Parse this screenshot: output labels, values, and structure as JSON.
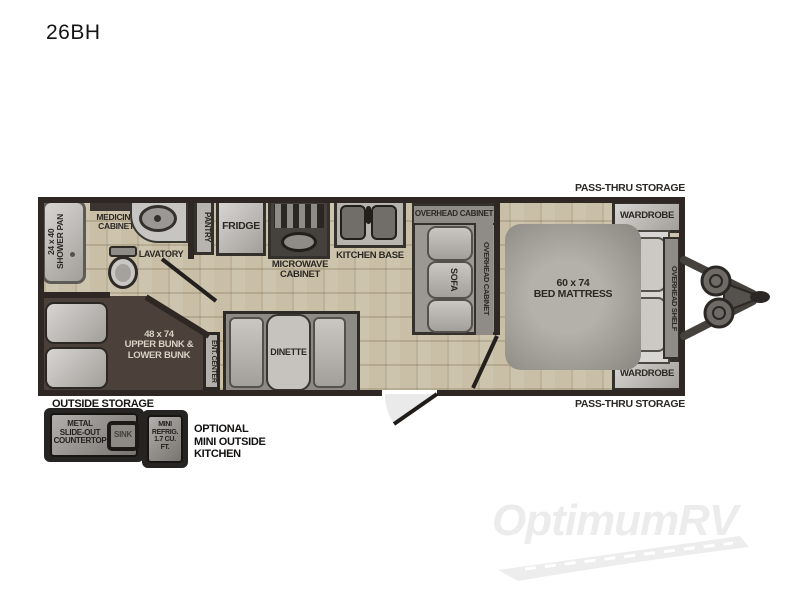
{
  "page": {
    "title": "26BH"
  },
  "plan": {
    "exterior": {
      "pass_thru_top": "PASS-THRU STORAGE",
      "pass_thru_bottom": "PASS-THRU STORAGE",
      "outside_storage": "OUTSIDE STORAGE"
    },
    "bathroom": {
      "shower": "24 x 40\nSHOWER PAN",
      "medicine_cabinet": "MEDICINE\nCABINET",
      "lavatory": "LAVATORY",
      "pantry": "PANTRY"
    },
    "kitchen": {
      "fridge": "FRIDGE",
      "microwave_cabinet": "MICROWAVE\nCABINET",
      "kitchen_base": "KITCHEN BASE",
      "overhead_cabinet_top": "OVERHEAD CABINET"
    },
    "living": {
      "sofa": "SOFA",
      "overhead_cabinet_side": "OVERHEAD CABINET",
      "dinette": "DINETTE",
      "ent_center": "ENT. CENTER",
      "bunks": "48 x 74\nUPPER BUNK &\nLOWER BUNK"
    },
    "bedroom": {
      "bed": "60 x 74\nBED MATTRESS",
      "wardrobe_top": "WARDROBE",
      "wardrobe_bottom": "WARDROBE",
      "overhead_shelf": "OVERHEAD SHELF"
    },
    "outside_kitchen": {
      "countertop": "METAL\nSLIDE-OUT\nCOUNTERTOP",
      "sink": "SINK",
      "mini_refrig": "MINI\nREFRIG.\n1.7 CU.\nFT.",
      "note": "OPTIONAL\nMINI OUTSIDE\nKITCHEN"
    }
  },
  "watermark": {
    "brand": "OptimumRV"
  },
  "colors": {
    "wall": "#2e2724",
    "floor": "#c9bfa7",
    "bunk_area": "#4b403a",
    "unit_dark": "#262422"
  }
}
